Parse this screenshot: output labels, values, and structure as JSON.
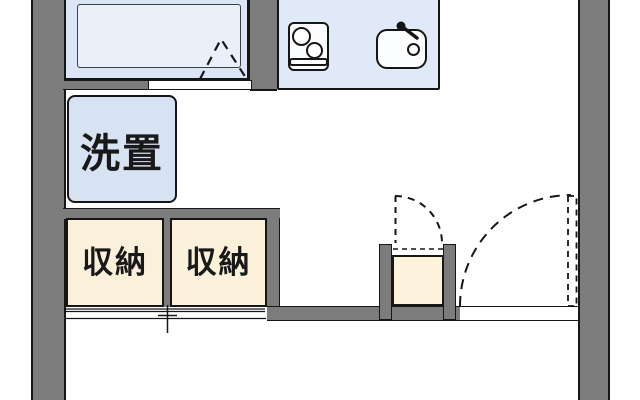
{
  "palette": {
    "wall_gray": "#7c7c7c",
    "outline": "#161616",
    "room_blue": "#dbe5f6",
    "tub_blue": "#eaf0fa",
    "kitchen_blue": "#dfe9f8",
    "laundry_blue": "#d7e2f3",
    "storage_cream": "#fbf1db",
    "closet_cream": "#fdf3dd"
  },
  "floorplan": {
    "labels": {
      "laundry_pan": "洗置",
      "storage_left": "収納",
      "storage_right": "収納"
    },
    "fixtures": [
      "bathtub",
      "stove-icon",
      "sink-icon",
      "faucet-icon",
      "drain-icon"
    ],
    "door_symbols": [
      "bathroom-folding-door",
      "shoe-closet-door-swing",
      "entrance-door-swing",
      "storage-sliding-door-track"
    ]
  }
}
